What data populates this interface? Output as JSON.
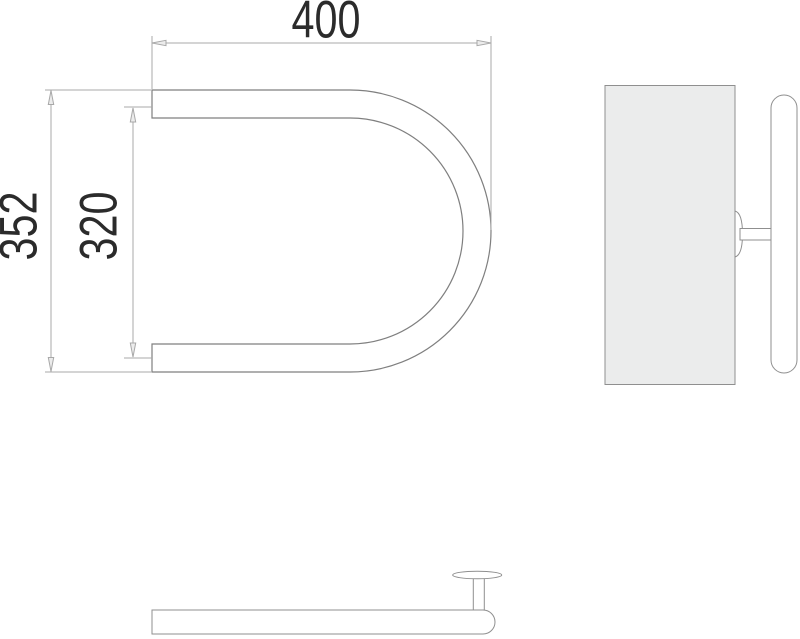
{
  "dimensions": {
    "width_top": "400",
    "height_outer": "352",
    "height_inner": "320"
  },
  "colors": {
    "background": "#ffffff",
    "object_line": "#7f7f7f",
    "detail_line": "#8f8f8f",
    "dimension_line": "#a8a8a8",
    "arrow_fill": "#ececec",
    "text": "#2b2b2b",
    "wall_panel_fill": "#ebecec",
    "tube_fill": "#ffffff"
  }
}
